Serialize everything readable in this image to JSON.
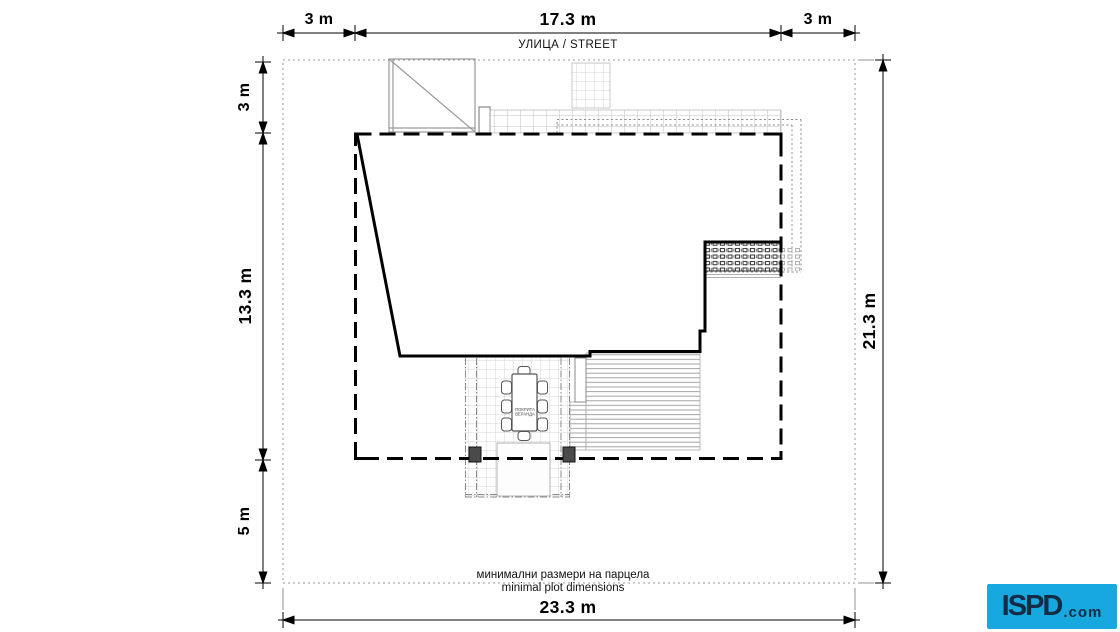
{
  "street_label": "УЛИЦА / STREET",
  "dimensions": {
    "top_left": "3 m",
    "top_center": "17.3 m",
    "top_right": "3 m",
    "left_top": "3 m",
    "left_middle": "13.3 m",
    "left_bottom": "5 m",
    "right_side": "21.3 m",
    "bottom": "23.3 m"
  },
  "plot": {
    "width_m": 23.3,
    "depth_m": 21.3,
    "buildable_width_m": 17.3,
    "buildable_depth_m": 13.3,
    "setback_front_m": 3,
    "setback_back_m": 5,
    "setback_side_left_m": 3,
    "setback_side_right_m": 3
  },
  "veranda": {
    "label_line1": "ПОКРИТА",
    "label_line2": "ВЕРАНДА"
  },
  "caption": {
    "line1_bg": "минимални размери на парцела",
    "line2_en": "minimal plot dimensions"
  },
  "logo": {
    "text": "ISPD",
    "suffix": ".com",
    "background": "#18a8e0",
    "text_color": "#122c46"
  },
  "colors": {
    "line": "#000000",
    "secondary_line": "#999999",
    "plot_boundary": "#9a9a9a"
  }
}
